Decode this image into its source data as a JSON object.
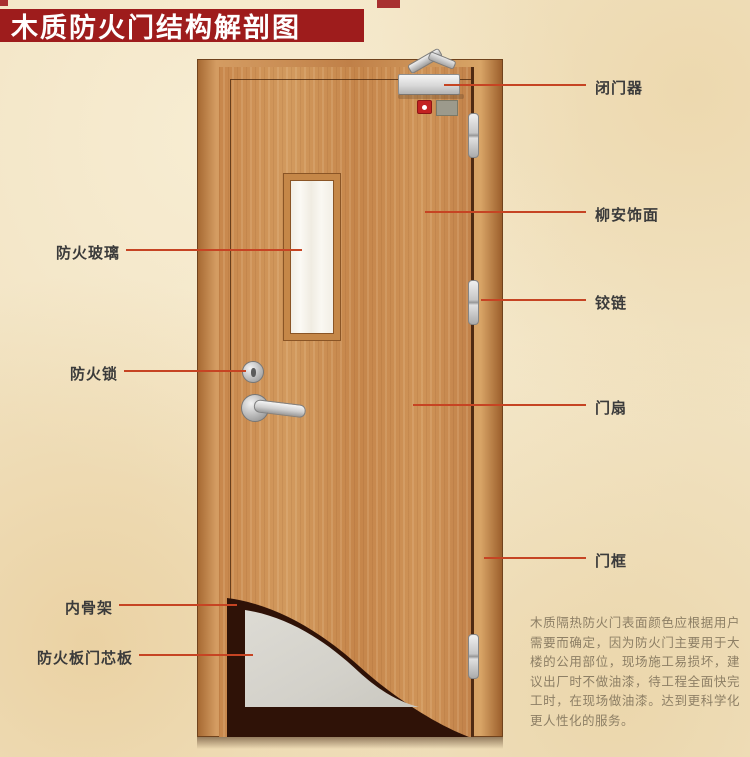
{
  "title": "木质防火门结构解剖图",
  "colors": {
    "banner": "#9e1c1c",
    "callout_line": "#c64423",
    "background": "#f2e4c4",
    "door_wood": "#cb8f53",
    "core_board": "#d5d3cc",
    "skeleton_dark": "#2f1207"
  },
  "labels": {
    "left": [
      {
        "text": "防火玻璃"
      },
      {
        "text": "防火锁"
      },
      {
        "text": "内骨架"
      },
      {
        "text": "防火板门芯板"
      }
    ],
    "right": [
      {
        "text": "闭门器"
      },
      {
        "text": "柳安饰面"
      },
      {
        "text": "铰链"
      },
      {
        "text": "门扇"
      },
      {
        "text": "门框"
      }
    ]
  },
  "description": "木质隔热防火门表面颜色应根据用户需要而确定，因为防火门主要用于大楼的公用部位，现场施工易损坏，建议出厂时不做油漆，待工程全面快完工时，在现场做油漆。达到更科学化更人性化的服务。"
}
